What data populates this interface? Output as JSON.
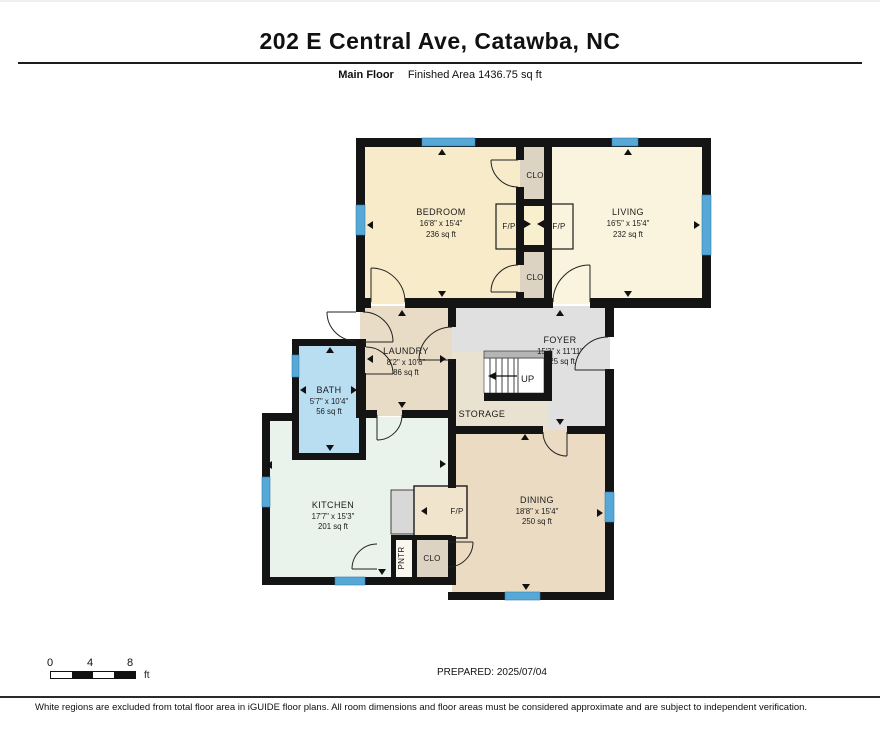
{
  "header": {
    "title": "202 E Central Ave, Catawba, NC",
    "floor_label": "Main Floor",
    "area_label": "Finished Area 1436.75 sq ft"
  },
  "rooms": {
    "bedroom": {
      "name": "BEDROOM",
      "dims": "16'8\" x 15'4\"",
      "area": "236 sq ft"
    },
    "living": {
      "name": "LIVING",
      "dims": "16'5\" x 15'4\"",
      "area": "232 sq ft"
    },
    "laundry": {
      "name": "LAUNDRY",
      "dims": "8'2\" x 10'6\"",
      "area": "86 sq ft"
    },
    "bath": {
      "name": "BATH",
      "dims": "5'7\" x 10'4\"",
      "area": "56 sq ft"
    },
    "foyer": {
      "name": "FOYER",
      "dims": "15'3\" x 11'11\"",
      "area": "125 sq ft"
    },
    "kitchen": {
      "name": "KITCHEN",
      "dims": "17'7\" x 15'3\"",
      "area": "201 sq ft"
    },
    "dining": {
      "name": "DINING",
      "dims": "18'8\" x 15'4\"",
      "area": "250 sq ft"
    },
    "storage": {
      "name": "STORAGE"
    }
  },
  "labels": {
    "closet": "CLO",
    "fireplace": "F/P",
    "pantry": "PNTR",
    "stairs_up": "UP"
  },
  "scale_bar": {
    "tick0": "0",
    "tick1": "4",
    "tick2": "8",
    "unit": "ft"
  },
  "footer": {
    "prepared": "PREPARED: 2025/07/04",
    "disclaimer": "White regions are excluded from total floor area in iGUIDE floor plans. All room dimensions and floor areas must be considered approximate and are subject to independent verification."
  },
  "colors": {
    "wall": "#141414",
    "window": "#57a8d6",
    "bedroom": "#f7ebc9",
    "living": "#faf4de",
    "closet": "#dcd3c2",
    "fp_center": "#f8efce",
    "laundry": "#e8dcc6",
    "foyer": "#e0e0e0",
    "storage": "#e9e2d1",
    "bath": "#b9def2",
    "kitchen": "#eaf2ec",
    "dining": "#ebdbc2",
    "pantry": "#faf7ee",
    "counter": "#d8d8d8",
    "fp_box": "#f0e4cc"
  }
}
